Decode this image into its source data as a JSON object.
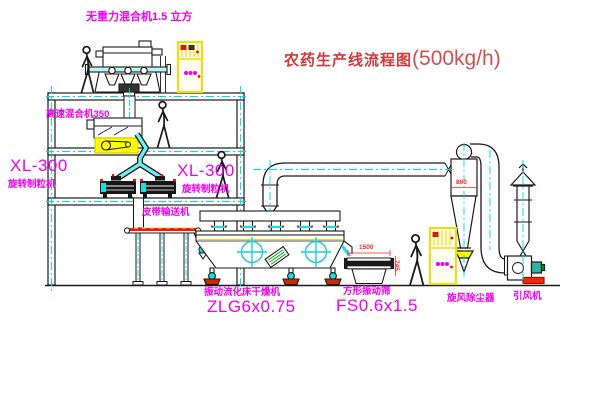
{
  "title": {
    "name": "农药生产线流程图",
    "capacity": "(500kg/h)"
  },
  "labels": {
    "gravity_mixer": "无重力混合机1.5 立方",
    "high_speed_mixer": "高速混合机350",
    "granulator_left_model": "XL-300",
    "granulator_left_name": "旋转制粒机",
    "granulator_right_model": "XL-300",
    "granulator_right_name": "旋转制粒机",
    "belt_conveyor": "皮带输送机",
    "dryer_name": "振动流化床干燥机",
    "dryer_model": "ZLG6x0.75",
    "screen_name": "方形振动筛",
    "screen_model": "FS0.6x1.5",
    "cyclone_name": "旋风除尘器",
    "fan_name": "引风机"
  },
  "dimensions": {
    "screen_width": "1500",
    "screen_height": "745",
    "cyclone_inlet": "800"
  },
  "colors": {
    "line": "#1a1a1a",
    "pipe_cyan": "#00dcdc",
    "label_magenta": "#f000f0",
    "title_red": "#cd3939",
    "dim_red": "#ff2222",
    "highlight_yellow": "#ffff00"
  }
}
